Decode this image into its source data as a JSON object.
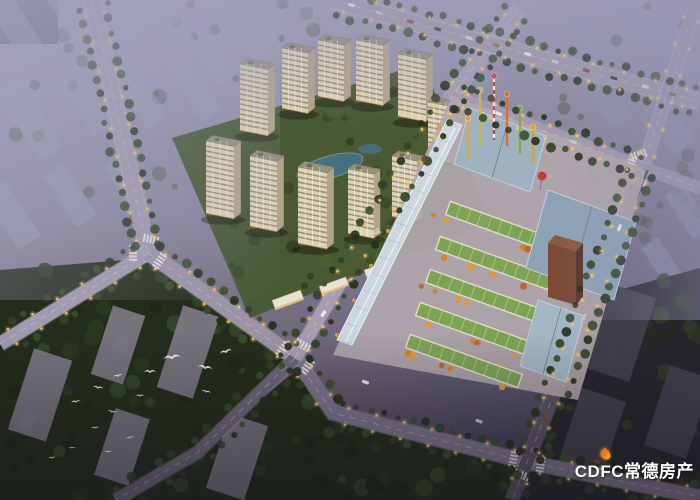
{
  "meta": {
    "description": "Aerial dusk rendering of a residential and commercial real-estate development",
    "style": "architectural-visualization"
  },
  "watermark": {
    "text": "CDFC常德房产",
    "color": "#ffffff",
    "flame_color": "#f0851c"
  },
  "palette": {
    "sky_top": "#a3a0bb",
    "sky_mid": "#8b87a0",
    "sky_bottom": "#49425a",
    "haze_block": "#9aa0b2",
    "road_light": "#a69db2",
    "road_dark": "#5a5464",
    "tree_dark": "#26311d",
    "tree_mid": "#354627",
    "tower_lit": "#ddd2b6",
    "tower_shade": "#b3a489",
    "green_roof": "#7ca454",
    "metal_roof": "#93a8ba",
    "brown_tower": "#7c4a36",
    "accent_orange": "#d8852c",
    "streetlight": "#f5c46a",
    "pond": "#47707e",
    "bird": "#eceef2"
  },
  "scene": {
    "residential": {
      "label": "residential tower cluster",
      "plot": [
        [
          172,
          138
        ],
        [
          422,
          64
        ],
        [
          492,
          222
        ],
        [
          250,
          318
        ]
      ],
      "towers": [
        [
          318,
          96,
          26,
          11,
          56
        ],
        [
          282,
          108,
          26,
          11,
          60
        ],
        [
          356,
          100,
          27,
          11,
          60
        ],
        [
          398,
          116,
          28,
          11,
          62
        ],
        [
          240,
          130,
          28,
          11,
          66
        ],
        [
          428,
          158,
          24,
          10,
          56
        ],
        [
          206,
          213,
          28,
          11,
          72
        ],
        [
          250,
          226,
          27,
          11,
          70
        ],
        [
          392,
          216,
          25,
          10,
          60
        ],
        [
          348,
          233,
          26,
          10,
          64
        ],
        [
          298,
          243,
          29,
          11,
          76
        ]
      ],
      "pond": {
        "cx": 330,
        "cy": 167,
        "rx": 34,
        "ry": 11,
        "rot": -16
      },
      "pond2": {
        "cx": 370,
        "cy": 149,
        "rx": 12,
        "ry": 5
      },
      "shops": [
        [
          288,
          300,
          30,
          10
        ],
        [
          334,
          286,
          28,
          9
        ],
        [
          378,
          270,
          26,
          9
        ]
      ]
    },
    "commercial": {
      "label": "commercial street block with green roofs",
      "plot": [
        [
          452,
          96
        ],
        [
          646,
          170
        ],
        [
          578,
          400
        ],
        [
          333,
          355
        ]
      ],
      "canopy": [
        [
          447,
          120
        ],
        [
          462,
          125
        ],
        [
          352,
          345
        ],
        [
          337,
          340
        ]
      ],
      "green_rows": [
        [
          [
            448,
            208
          ],
          [
            562,
            249
          ]
        ],
        [
          [
            438,
            243
          ],
          [
            550,
            283
          ]
        ],
        [
          [
            428,
            276
          ],
          [
            540,
            316
          ]
        ],
        [
          [
            418,
            309
          ],
          [
            530,
            349
          ]
        ],
        [
          [
            408,
            341
          ],
          [
            520,
            381
          ]
        ]
      ],
      "row_width": 14,
      "big_roofs": [
        {
          "pts": [
            [
              470,
              108
            ],
            [
              546,
              136
            ],
            [
              530,
              192
            ],
            [
              454,
              164
            ]
          ],
          "fill": "#9fb2c2"
        },
        {
          "pts": [
            [
              548,
              190
            ],
            [
              636,
              222
            ],
            [
              614,
              300
            ],
            [
              526,
              268
            ]
          ],
          "fill": "#8da2b5"
        },
        {
          "pts": [
            [
              538,
              300
            ],
            [
              584,
              316
            ],
            [
              566,
              382
            ],
            [
              520,
              366
            ]
          ],
          "fill": "#a4b6c4"
        }
      ],
      "brown_tower": {
        "front": [
          [
            548,
            243
          ],
          [
            576,
            251
          ],
          [
            576,
            305
          ],
          [
            548,
            297
          ]
        ],
        "top": [
          [
            548,
            243
          ],
          [
            555,
            235
          ],
          [
            583,
            243
          ],
          [
            576,
            251
          ]
        ],
        "side": [
          [
            576,
            251
          ],
          [
            583,
            243
          ],
          [
            583,
            297
          ],
          [
            576,
            305
          ]
        ]
      },
      "poles": [
        [
          468,
          160,
          40,
          "#d8a838"
        ],
        [
          480,
          148,
          56,
          "#c8b84a"
        ],
        [
          494,
          140,
          62,
          "#cc4444"
        ],
        [
          507,
          146,
          50,
          "#d87028"
        ],
        [
          520,
          154,
          44,
          "#88a848"
        ],
        [
          533,
          163,
          34,
          "#e0a030"
        ]
      ],
      "balloon": {
        "cx": 542,
        "cy": 176,
        "r": 4.5,
        "fill": "#c83c30"
      }
    },
    "roads": [
      {
        "name": "north-avenue",
        "pts": [
          [
            92,
            0
          ],
          [
            148,
            253
          ]
        ],
        "w": 15,
        "c": "#a29ab0",
        "lights": true,
        "trees": true
      },
      {
        "name": "west-avenue",
        "pts": [
          [
            0,
            344
          ],
          [
            148,
            253
          ]
        ],
        "w": 14,
        "c": "#a29ab0",
        "lights": true,
        "trees": true
      },
      {
        "name": "main-boulevard",
        "pts": [
          [
            148,
            253
          ],
          [
            295,
            358
          ]
        ],
        "w": 15,
        "c": "#9c93a6",
        "lights": true,
        "trees": true
      },
      {
        "name": "southeast-road",
        "pts": [
          [
            295,
            358
          ],
          [
            333,
            413
          ],
          [
            527,
            462
          ],
          [
            700,
            497
          ]
        ],
        "w": 14,
        "c": "#7e768c",
        "lights": true,
        "trees": true,
        "cars": 3
      },
      {
        "name": "southwest-road",
        "pts": [
          [
            295,
            358
          ],
          [
            198,
            452
          ],
          [
            116,
            500
          ]
        ],
        "w": 12,
        "c": "#6e6678",
        "lights": false,
        "trees": true
      },
      {
        "name": "frontage-road",
        "pts": [
          [
            295,
            358
          ],
          [
            450,
            98
          ],
          [
            520,
            8
          ]
        ],
        "w": 13,
        "c": "#a69db2",
        "lights": true,
        "trees": true,
        "cars": 4
      },
      {
        "name": "north-artery",
        "pts": [
          [
            333,
            0
          ],
          [
            575,
            68
          ],
          [
            700,
            102
          ]
        ],
        "w": 15,
        "c": "#9e96ac",
        "lights": true,
        "trees": true,
        "cars": 12
      },
      {
        "name": "northeast-road",
        "pts": [
          [
            695,
            6
          ],
          [
            643,
            168
          ]
        ],
        "w": 12,
        "c": "#9a92a8",
        "lights": true,
        "trees": false
      },
      {
        "name": "east-stub",
        "pts": [
          [
            643,
            168
          ],
          [
            700,
            188
          ]
        ],
        "w": 11,
        "c": "#9a92a8",
        "lights": false,
        "trees": false
      },
      {
        "name": "east-road-dark",
        "pts": [
          [
            643,
            168
          ],
          [
            527,
            462
          ],
          [
            512,
            500
          ]
        ],
        "w": 13,
        "c": "#5a5464",
        "lights": true,
        "trees": true,
        "cars": 3
      },
      {
        "name": "commercial-top-road",
        "pts": [
          [
            452,
            96
          ],
          [
            643,
            168
          ]
        ],
        "w": 11,
        "c": "#a39ab0",
        "lights": true,
        "trees": true,
        "cars": 2
      }
    ],
    "intersections": [
      [
        148,
        253
      ],
      [
        295,
        358
      ],
      [
        643,
        168
      ],
      [
        527,
        462
      ]
    ],
    "haze_blocks_topleft": [
      [
        18,
        30,
        26,
        70
      ],
      [
        68,
        12,
        24,
        60
      ],
      [
        118,
        8,
        26,
        64
      ],
      [
        170,
        22,
        24,
        58
      ],
      [
        222,
        12,
        22,
        52
      ],
      [
        30,
        120,
        28,
        80
      ],
      [
        85,
        100,
        26,
        72
      ],
      [
        140,
        95,
        24,
        66
      ],
      [
        195,
        90,
        22,
        60
      ],
      [
        12,
        215,
        26,
        66
      ],
      [
        70,
        195,
        24,
        62
      ],
      [
        128,
        185,
        22,
        56
      ],
      [
        215,
        60,
        20,
        48
      ],
      [
        248,
        35,
        20,
        46
      ],
      [
        270,
        12,
        18,
        40
      ]
    ],
    "corner_slab": [
      0,
      0,
      58,
      44
    ],
    "haze_blocks_top": [
      [
        262,
        20,
        20,
        46
      ],
      [
        300,
        9,
        18,
        40
      ],
      [
        388,
        14,
        20,
        44
      ],
      [
        418,
        40,
        18,
        38
      ],
      [
        303,
        52,
        16,
        34
      ]
    ],
    "haze_blocks_right": [
      [
        590,
        40,
        26,
        64
      ],
      [
        632,
        20,
        24,
        58
      ],
      [
        674,
        48,
        26,
        62
      ],
      [
        608,
        100,
        24,
        56
      ],
      [
        668,
        122,
        26,
        60
      ],
      [
        688,
        212,
        22,
        52
      ],
      [
        662,
        262,
        20,
        46
      ]
    ],
    "forest_blocks": [
      [
        40,
        395,
        40,
        85
      ],
      [
        118,
        345,
        34,
        72
      ],
      [
        188,
        352,
        38,
        86
      ],
      [
        122,
        447,
        36,
        70
      ],
      [
        237,
        457,
        40,
        78
      ]
    ],
    "dark_blocks": [
      [
        618,
        332,
        52,
        88
      ],
      [
        592,
        432,
        46,
        78
      ],
      [
        678,
        412,
        44,
        84
      ]
    ],
    "forest_polys": [
      [
        [
          0,
          270
        ],
        [
          150,
          258
        ],
        [
          300,
          352
        ],
        [
          200,
          452
        ],
        [
          116,
          500
        ],
        [
          0,
          500
        ]
      ],
      [
        [
          300,
          368
        ],
        [
          333,
          415
        ],
        [
          527,
          458
        ],
        [
          512,
          500
        ],
        [
          130,
          500
        ]
      ],
      [
        [
          582,
          300
        ],
        [
          700,
          268
        ],
        [
          700,
          500
        ],
        [
          518,
          500
        ]
      ]
    ],
    "birds": [
      [
        172,
        358,
        1.8,
        -8
      ],
      [
        205,
        368,
        1.5,
        10
      ],
      [
        150,
        372,
        1.2,
        0
      ],
      [
        118,
        376,
        1.0,
        -12
      ],
      [
        98,
        388,
        1.1,
        8
      ],
      [
        140,
        396,
        0.9,
        0
      ],
      [
        76,
        402,
        1.0,
        -6
      ],
      [
        112,
        412,
        0.9,
        12
      ],
      [
        95,
        428,
        0.8,
        0
      ],
      [
        130,
        438,
        0.9,
        -10
      ],
      [
        108,
        452,
        0.8,
        6
      ],
      [
        72,
        448,
        0.7,
        0
      ],
      [
        52,
        458,
        0.8,
        -8
      ],
      [
        206,
        392,
        1.0,
        14
      ],
      [
        226,
        352,
        1.3,
        -15
      ]
    ]
  }
}
